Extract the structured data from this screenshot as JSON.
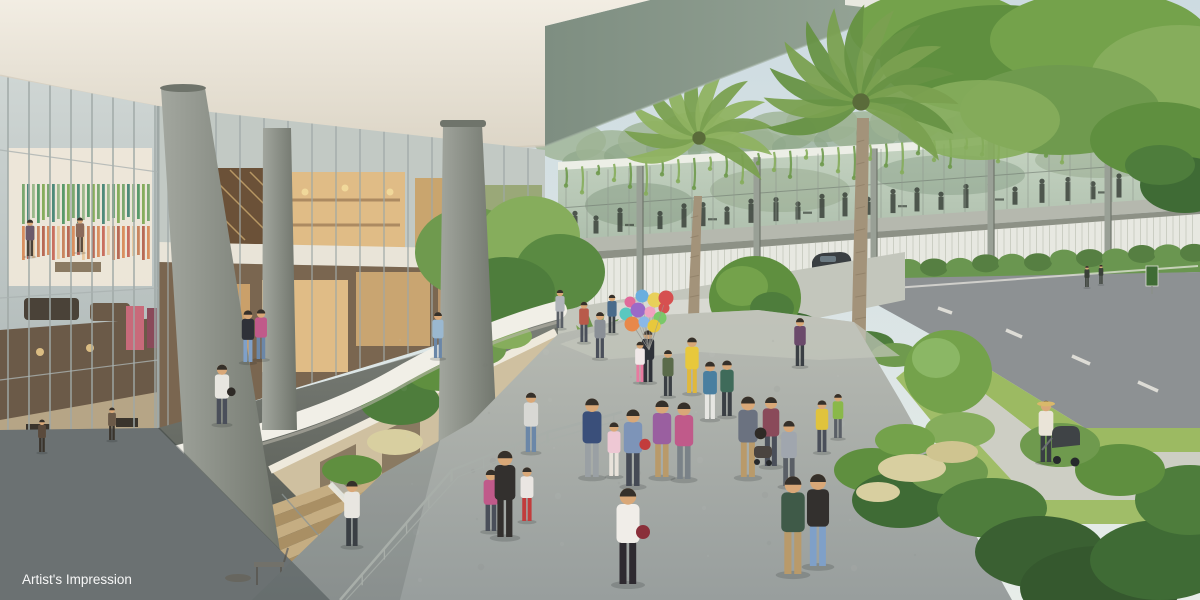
{
  "caption": {
    "text": "Artist's Impression"
  },
  "scene": {
    "type": "architectural-rendering",
    "subject": "retail galleria with sunken garden stair, pedestrian plaza, elevated glazed dining link bridge, palms and roadside garden walk",
    "palette": {
      "sky_top": "#cddbe1",
      "sky_bottom": "#e7ede9",
      "cloud": "#f0f4f4",
      "soffit_left": "#7e8e81",
      "soffit_right": "#97a698",
      "soffit_edge": "#e8e8e0",
      "ceiling_top": "#f2ede3",
      "ceiling_bottom": "#dcd5c6",
      "glass_top": "#cfd6d4",
      "glass_bottom": "#a8b2b1",
      "mullion": "#9fa8a6",
      "fascia": "#e9e4d8",
      "column_light": "#a3a79f",
      "column_dark": "#6f746b",
      "plaza_top": "#b8bbb3",
      "plaza_bottom": "#989e9d",
      "shadow": "#20282b",
      "walkway": "#a6aba7",
      "parapet": "#f1efe7",
      "parapet_shadow": "#b9b6aa",
      "wood": "#c5ad82",
      "wood_dark": "#a98f64",
      "glazing": "#aebfad",
      "glazing_hi": "#c9d7c5",
      "silhouette": "#3b423b",
      "fence": "#e7e8e1",
      "fence_line": "#c5c8bc",
      "floorband": "#b5b8ae",
      "leaf_dark": "#3f6b35",
      "leaf_mid": "#5f8f3f",
      "leaf_light": "#86ad5c",
      "leaf_pale": "#a9cc82",
      "palm_a": "#7aa050",
      "palm_b": "#679244",
      "trunk": "#a3937a",
      "treeline": "#9db394",
      "grass": "#9cba62",
      "road": "#8d9193",
      "lane": "#eceae2",
      "path": "#cdcec4",
      "hedge": "#567f42",
      "flower": "#d8cfa0",
      "interior_warm": "#c9a56e",
      "interior_bright": "#e0bc86",
      "interior_dark": "#6b5138",
      "art_wall": "#f0e8da",
      "poster_a": "#c86a7a",
      "poster_b": "#8a4a5a",
      "void_top": "#7b7f78",
      "void_bottom": "#4f534c",
      "deck_wall": "#cfc0a0",
      "white_trim": "#eee9dc",
      "rail": "#a8aea9",
      "skin": "#d9a878",
      "hair": "#35302a",
      "car": "#3a3f42",
      "caption_color": "#ffffff"
    },
    "art_stripes": {
      "greens": [
        "#7ba86f",
        "#4e8a7a",
        "#9ab88a",
        "#5a9a6a",
        "#86ad5c"
      ],
      "warms": [
        "#d98f5f",
        "#c96f5f",
        "#e8c9a0",
        "#c9855f",
        "#b86a55"
      ]
    },
    "balloons": {
      "cx": 646,
      "cy": 314,
      "colors": [
        "#e06a9a",
        "#6aaede",
        "#e8d05a",
        "#d65050",
        "#5ac8c0",
        "#9a6ac8",
        "#f0a0c0",
        "#7ac86a",
        "#e8884a",
        "#8ab8e8",
        "#e8c83c",
        "#d65050"
      ]
    },
    "bridge_people_x": [
      575,
      596,
      620,
      641,
      660,
      684,
      703,
      727,
      751,
      776,
      798,
      822,
      845,
      868,
      893,
      917,
      941,
      966,
      990,
      1015,
      1042,
      1068,
      1093,
      1119,
      1146,
      1172
    ],
    "people": [
      {
        "x": 592,
        "y": 477,
        "h": 82,
        "shirt": "#3a4f7a",
        "pants": "#9aa0a4"
      },
      {
        "x": 614,
        "y": 476,
        "h": 56,
        "shirt": "#eec8d4",
        "pants": "#e8e2da"
      },
      {
        "x": 633,
        "y": 486,
        "h": 80,
        "shirt": "#7d94b8",
        "pants": "#454a55",
        "bag": "#c23c3c"
      },
      {
        "x": 662,
        "y": 477,
        "h": 80,
        "shirt": "#9a5fa0",
        "pants": "#b99a6a"
      },
      {
        "x": 684,
        "y": 479,
        "h": 80,
        "shirt": "#c05a8a",
        "pants": "#7a8288"
      },
      {
        "x": 710,
        "y": 419,
        "h": 60,
        "shirt": "#4a7fa0",
        "pants": "#e6e6e2"
      },
      {
        "x": 727,
        "y": 416,
        "h": 58,
        "shirt": "#3f6b5a",
        "pants": "#3a3f44"
      },
      {
        "x": 748,
        "y": 477,
        "h": 84,
        "shirt": "#6b7280",
        "pants": "#b99a6a",
        "bag": "#2e2a26"
      },
      {
        "x": 771,
        "y": 466,
        "h": 72,
        "shirt": "#8a4a5a",
        "pants": "#4a4f5a"
      },
      {
        "x": 789,
        "y": 486,
        "h": 68,
        "shirt": "#a0a6ae",
        "pants": "#5a5f66"
      },
      {
        "x": 628,
        "y": 584,
        "h": 100,
        "shirt": "#f0ede8",
        "pants": "#2e2a30",
        "bag": "#8a2f3a"
      },
      {
        "x": 505,
        "y": 537,
        "h": 90,
        "shirt": "#33302e",
        "pants": "#33302e"
      },
      {
        "x": 527,
        "y": 521,
        "h": 56,
        "shirt": "#eae6e2",
        "pants": "#c23c3c"
      },
      {
        "x": 491,
        "y": 531,
        "h": 64,
        "shirt": "#c05a8a",
        "pants": "#4a4f5a"
      },
      {
        "x": 793,
        "y": 574,
        "h": 102,
        "shirt": "#3f5a48",
        "pants": "#b99a6a"
      },
      {
        "x": 818,
        "y": 566,
        "h": 96,
        "shirt": "#33302e",
        "pants": "#7fa0c8"
      },
      {
        "x": 1046,
        "y": 462,
        "h": 64,
        "shirt": "#eae4d8",
        "pants": "#3a3f44",
        "hat": "#d9b86a"
      },
      {
        "x": 822,
        "y": 452,
        "h": 54,
        "shirt": "#e0c33c",
        "pants": "#4a4f5a"
      },
      {
        "x": 838,
        "y": 438,
        "h": 46,
        "shirt": "#8ab84a",
        "pants": "#5a5f66"
      },
      {
        "x": 648,
        "y": 382,
        "h": 54,
        "shirt": "#2e3138",
        "pants": "#2e3138"
      },
      {
        "x": 692,
        "y": 393,
        "h": 58,
        "shirt": "#e8c83c",
        "pants": "#e0b83c"
      },
      {
        "x": 640,
        "y": 382,
        "h": 42,
        "shirt": "#f0e8e8",
        "pants": "#e87aa0"
      },
      {
        "x": 600,
        "y": 358,
        "h": 48,
        "shirt": "#8a8f96",
        "pants": "#4a4f5a"
      },
      {
        "x": 584,
        "y": 342,
        "h": 42,
        "shirt": "#b85a4a",
        "pants": "#4a4f5a"
      },
      {
        "x": 800,
        "y": 366,
        "h": 50,
        "shirt": "#6b4a6b",
        "pants": "#3a3f44"
      },
      {
        "x": 248,
        "y": 362,
        "h": 54,
        "shirt": "#2e3138",
        "pants": "#7fa0c8"
      },
      {
        "x": 261,
        "y": 359,
        "h": 52,
        "shirt": "#c05a8a",
        "pants": "#6b87a8"
      },
      {
        "x": 222,
        "y": 424,
        "h": 62,
        "shirt": "#e8e6e0",
        "pants": "#4a4f5a",
        "bag": "#2e2a26"
      },
      {
        "x": 352,
        "y": 546,
        "h": 68,
        "shirt": "#e8e6e0",
        "pants": "#3a3f44"
      },
      {
        "x": 438,
        "y": 358,
        "h": 48,
        "shirt": "#9ab8d0",
        "pants": "#6b87a8"
      },
      {
        "x": 531,
        "y": 452,
        "h": 62,
        "shirt": "#d8d8d4",
        "pants": "#6b87a8"
      },
      {
        "x": 560,
        "y": 328,
        "h": 40,
        "shirt": "#b0b4ba",
        "pants": "#5a5f66"
      },
      {
        "x": 1087,
        "y": 287,
        "h": 22,
        "shirt": "#3a4038",
        "pants": "#3a4038"
      },
      {
        "x": 1101,
        "y": 284,
        "h": 20,
        "shirt": "#3a4038",
        "pants": "#3a4038"
      },
      {
        "x": 612,
        "y": 333,
        "h": 40,
        "shirt": "#4a6b8a",
        "pants": "#3a3f44"
      },
      {
        "x": 668,
        "y": 396,
        "h": 48,
        "shirt": "#5a6b4a",
        "pants": "#3a3f44"
      },
      {
        "x": 30,
        "y": 256,
        "h": 38,
        "shirt": "#6b5a6b",
        "pants": "#4a4238"
      },
      {
        "x": 80,
        "y": 252,
        "h": 36,
        "shirt": "#8a6a5a",
        "pants": "#5a4a3c"
      },
      {
        "x": 42,
        "y": 452,
        "h": 34,
        "shirt": "#5a4a3c",
        "pants": "#3a342c"
      },
      {
        "x": 112,
        "y": 440,
        "h": 34,
        "shirt": "#6b5a48",
        "pants": "#3a342c"
      }
    ]
  }
}
